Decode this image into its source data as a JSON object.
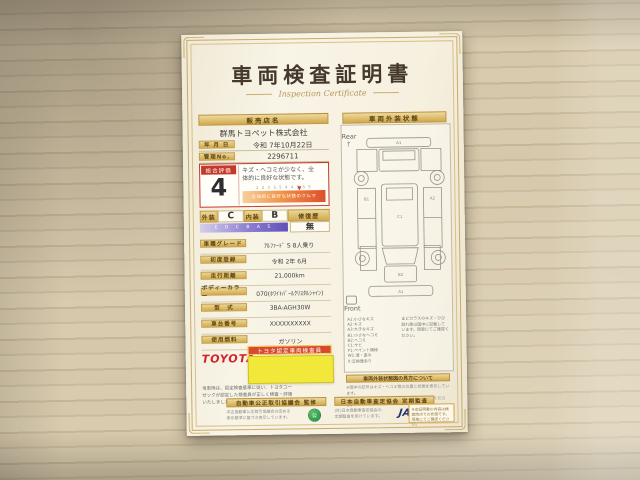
{
  "colors": {
    "gold": "#d2a94a",
    "red": "#c3392b",
    "paper": "#f6f1e2",
    "sticky_yellow": "#f2e839",
    "toyota_red": "#d2232a",
    "jaai_navy": "#1c2f6e"
  },
  "certificate": {
    "title": "車両検査証明書",
    "subtitle": "Inspection Certificate",
    "left": {
      "dealer_header": "販売店名",
      "dealer_name": "群馬トヨペット株式会社",
      "date_label": "年 月 日",
      "date_value": "令和 7年10月22日",
      "mgmt_label": "管理No.",
      "mgmt_value": "2296711",
      "eval": {
        "label": "総合評価",
        "score": "4",
        "desc1": "キズ・ヘコミが少なく、全",
        "desc2": "体的に良好な状態です。",
        "scale_ticks": "1  2  3  3.5  4  4.5  5  S",
        "bar_caption": "全体的に良好な状態のクルマ"
      },
      "grade_row": {
        "exterior_label": "外装",
        "exterior": "C",
        "interior_label": "内装",
        "interior": "B",
        "repair_label": "修復歴",
        "repair": "無",
        "grade_ticks": "E D C B A S"
      },
      "rows": [
        {
          "label": "車種グレード",
          "value": "ｱﾙﾌｧｰﾄﾞ S 8人乗り"
        },
        {
          "label": "初度登録",
          "value": "令和 2年 6月"
        },
        {
          "label": "走行距離",
          "value": "21,000km"
        },
        {
          "label": "ボディーカラー",
          "value": "070(ﾎﾜｲﾄﾊﾟｰﾙｸﾘｽﾀﾙｼｬｲﾝ)"
        },
        {
          "label": "型　式",
          "value": "3BA-AGH30W"
        },
        {
          "label": "車台番号",
          "value": "XXXXXXXXXX"
        },
        {
          "label": "使用燃料",
          "value": "ガソリン"
        }
      ],
      "brand": "TOYOTA",
      "inspector_badge": "トヨタ認定車両検査員",
      "note_line1": "当車両は、認定検査基準に従い、トヨタユー",
      "note_line2": "ゼックが認定した検査員が正しく検査・評価",
      "note_line3": "いたしました。"
    },
    "right": {
      "header": "車両外装状態",
      "rear_label": "Rear",
      "rear_arrow": "↑",
      "front_label": "Front",
      "diagram_labels": [
        "A1",
        "B1",
        "A2",
        "C1",
        "B2",
        "A1"
      ],
      "legend_left": [
        "A1:小さなキズ",
        "A2:キズ",
        "A3:大きなキズ",
        "B1:小さなヘコミ",
        "B2:ヘコミ",
        "C1:サビ",
        "P1:ペイント補修",
        "W1:波・歪み",
        "X:交換歴あり"
      ],
      "legend_right": [
        "まどガラスのキズ・ひび",
        "割れ等は図中に記載して",
        "います。現車にてご確認ください。"
      ],
      "howto_header": "車両外装状態図の見方について",
      "howto_line1": "※図中の記号はキズ・ヘコミ等の位置と状態を表示しています。",
      "howto_line2": "※詳しい状態は販売店スタッフまでお問い合わせください。"
    },
    "footer": {
      "left_badge": "自動車公正取引協議会 監修",
      "left_sub1": "中古自動車公正取引協議会の定める",
      "left_sub2": "表示基準に基づき表示しています。",
      "emblem_text": "公",
      "right_badge": "日本自動車査定協会 定期監査",
      "right_sub1": "(社)日本自動車査定協会の",
      "right_sub2": "定期監査を受けています。",
      "jaai": "JAAI",
      "note_line1": "※本証明書の内容は検",
      "note_line2": "査時点での状態です。",
      "note_line3": "現車にてご確認ください。"
    }
  }
}
